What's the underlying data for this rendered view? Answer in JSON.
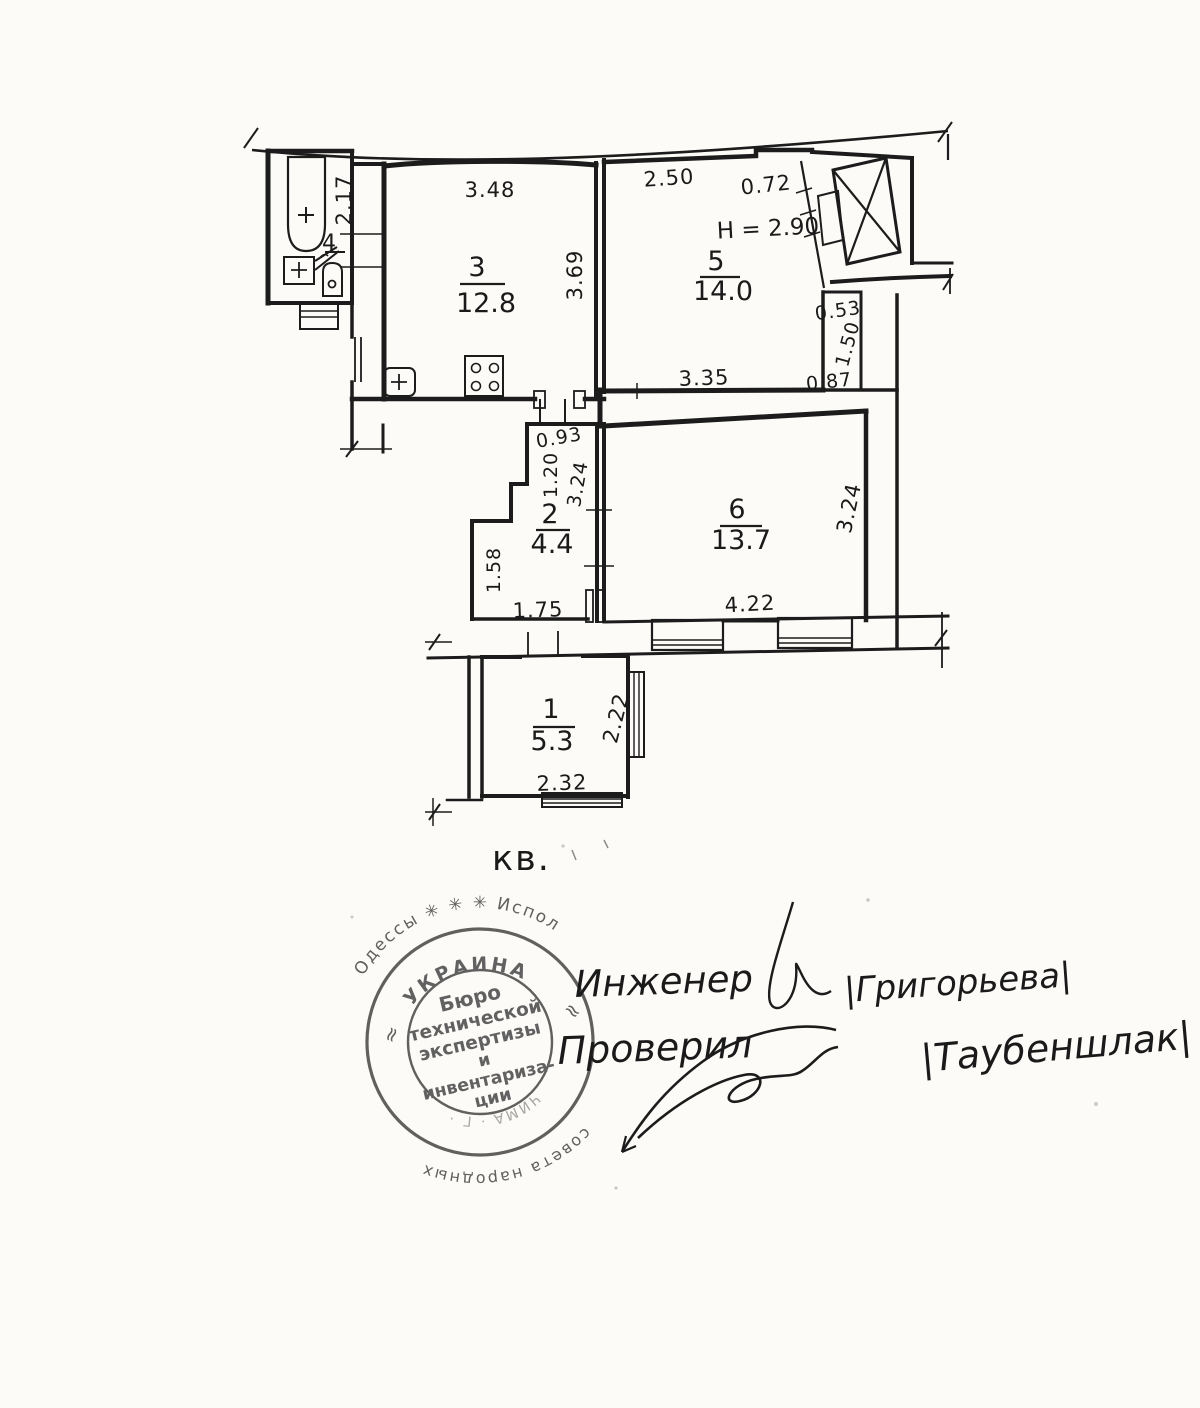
{
  "document": {
    "unit_label": "кв.",
    "plan": {
      "height_note": "H = 2.90",
      "rooms": {
        "r1": {
          "number": "1",
          "area": "5.3"
        },
        "r2": {
          "number": "2",
          "area": "4.4"
        },
        "r3": {
          "number": "3",
          "area": "12.8"
        },
        "r4": {
          "number": "4"
        },
        "r5": {
          "number": "5",
          "area": "14.0"
        },
        "r6": {
          "number": "6",
          "area": "13.7"
        }
      },
      "dimensions": {
        "bath_side": "2.17",
        "r3_top": "3.48",
        "r3_right": "3.69",
        "r5_top_left": "2.50",
        "r5_top_right": "0.72",
        "r5_bottom": "3.35",
        "nook_top": "0.53",
        "nook_side": "1.50",
        "nook_bottom": "0.87",
        "r2_top": "0.93",
        "r2_left_upper": "1.20",
        "r2_right": "3.24",
        "r2_left_lower": "1.58",
        "r2_bottom": "1.75",
        "r6_right": "3.24",
        "r6_bottom": "4.22",
        "r1_right": "2.22",
        "r1_bottom": "2.32"
      }
    },
    "stamp": {
      "outer_top": "Одессы ✳ ✳ ✳ Испол",
      "outer_bottom": "совета народных",
      "inner_ring": "УКРАИНА",
      "ring_mark_left": "≈",
      "ring_mark_right": "≈",
      "center_lines": [
        "Бюро",
        "технической",
        "экспертизы",
        "и",
        "инвентариза-",
        "ции"
      ],
      "bottom_fragment": "ЧИМА · Г ·"
    },
    "signatures": {
      "line1_label": "Инженер",
      "line1_name": "|Григорьева|",
      "line2_label": "Проверил",
      "line2_name": "|Таубеншлак|"
    }
  }
}
